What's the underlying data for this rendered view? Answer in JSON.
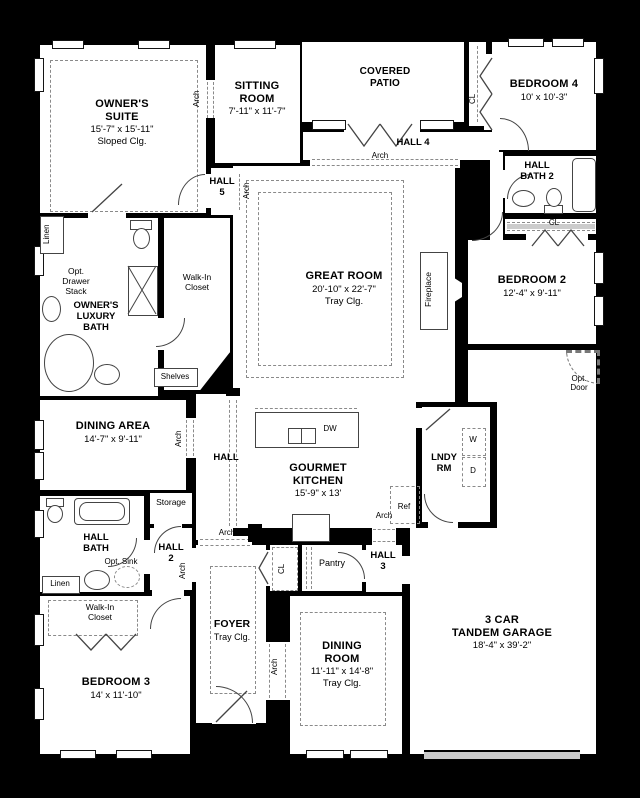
{
  "rooms": {
    "owners_suite": {
      "name": "OWNER'S\nSUITE",
      "dims": "15'-7\" x 15'-11\"",
      "ceiling": "Sloped Clg."
    },
    "sitting_room": {
      "name": "SITTING\nROOM",
      "dims": "7'-11\" x 11'-7\""
    },
    "covered_patio": {
      "name": "COVERED\nPATIO"
    },
    "hall4": {
      "name": "HALL 4"
    },
    "hall5": {
      "name": "HALL\n5"
    },
    "bedroom4": {
      "name": "BEDROOM 4",
      "dims": "10' x 10'-3\""
    },
    "hall_bath2": {
      "name": "HALL\nBATH 2"
    },
    "bedroom2": {
      "name": "BEDROOM 2",
      "dims": "12'-4\" x 9'-11\""
    },
    "great_room": {
      "name": "GREAT ROOM",
      "dims": "20'-10\" x 22'-7\"",
      "ceiling": "Tray Clg."
    },
    "owners_bath": {
      "name": "OWNER'S\nLUXURY\nBATH"
    },
    "dining_area": {
      "name": "DINING AREA",
      "dims": "14'-7\" x 9'-11\""
    },
    "kitchen": {
      "name": "GOURMET\nKITCHEN",
      "dims": "15'-9\" x 13'"
    },
    "laundry": {
      "name": "LNDY\nRM"
    },
    "hall_bath": {
      "name": "HALL\nBATH"
    },
    "hall2": {
      "name": "HALL\n2"
    },
    "hall3": {
      "name": "HALL\n3"
    },
    "foyer": {
      "name": "FOYER",
      "ceiling": "Tray Clg."
    },
    "bedroom3": {
      "name": "BEDROOM 3",
      "dims": "14' x 11'-10\""
    },
    "dining_room": {
      "name": "DINING\nROOM",
      "dims": "11'-11\" x 14'-8\"",
      "ceiling": "Tray Clg."
    },
    "garage": {
      "name": "3 CAR\nTANDEM GARAGE",
      "dims": "18'-4\" x 39'-2\""
    }
  },
  "labels": {
    "arch": "Arch",
    "cl": "CL",
    "linen": "Linen",
    "shelves": "Shelves",
    "fireplace": "Fireplace",
    "hall": "HALL",
    "storage": "Storage",
    "pantry": "Pantry",
    "walk_in_closet": "Walk-In\nCloset",
    "opt_drawer_stack": "Opt.\nDrawer\nStack",
    "opt_sink": "Opt. Sink",
    "opt_door": "Opt.\nDoor",
    "dw": "DW",
    "ref": "Ref",
    "washer": "W",
    "dryer": "D"
  },
  "colors": {
    "background": "#000000",
    "floor": "#ffffff",
    "wall": "#000000",
    "detail_line": "#444444",
    "dashed_line": "#8a8a8a",
    "garage_door": "#c9c9c9"
  }
}
